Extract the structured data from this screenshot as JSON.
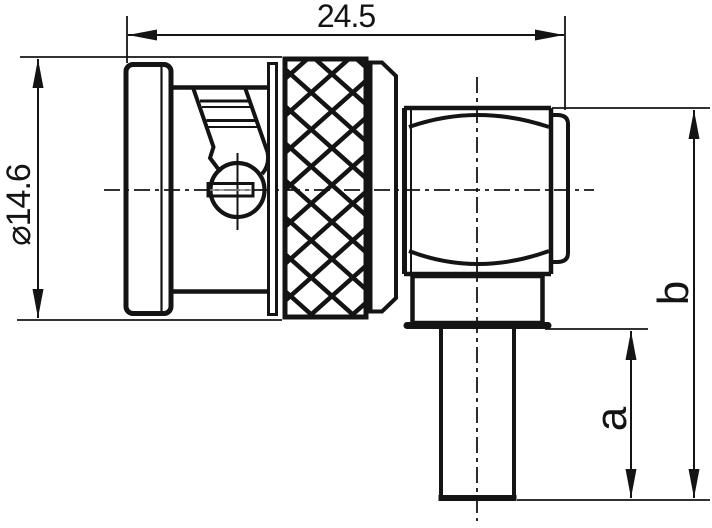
{
  "page": {
    "background": "#ffffff",
    "ink": "#141414"
  },
  "drawing": {
    "kind": "technical-dimension-drawing",
    "subject": "right-angle coaxial connector side view",
    "dimensions": [
      {
        "id": "overall-length",
        "label": "24.5",
        "orientation": "horizontal"
      },
      {
        "id": "diameter",
        "label": "⌀14.6",
        "orientation": "vertical"
      },
      {
        "id": "dim-a",
        "label": "a",
        "orientation": "vertical"
      },
      {
        "id": "dim-b",
        "label": "b",
        "orientation": "vertical"
      }
    ]
  }
}
